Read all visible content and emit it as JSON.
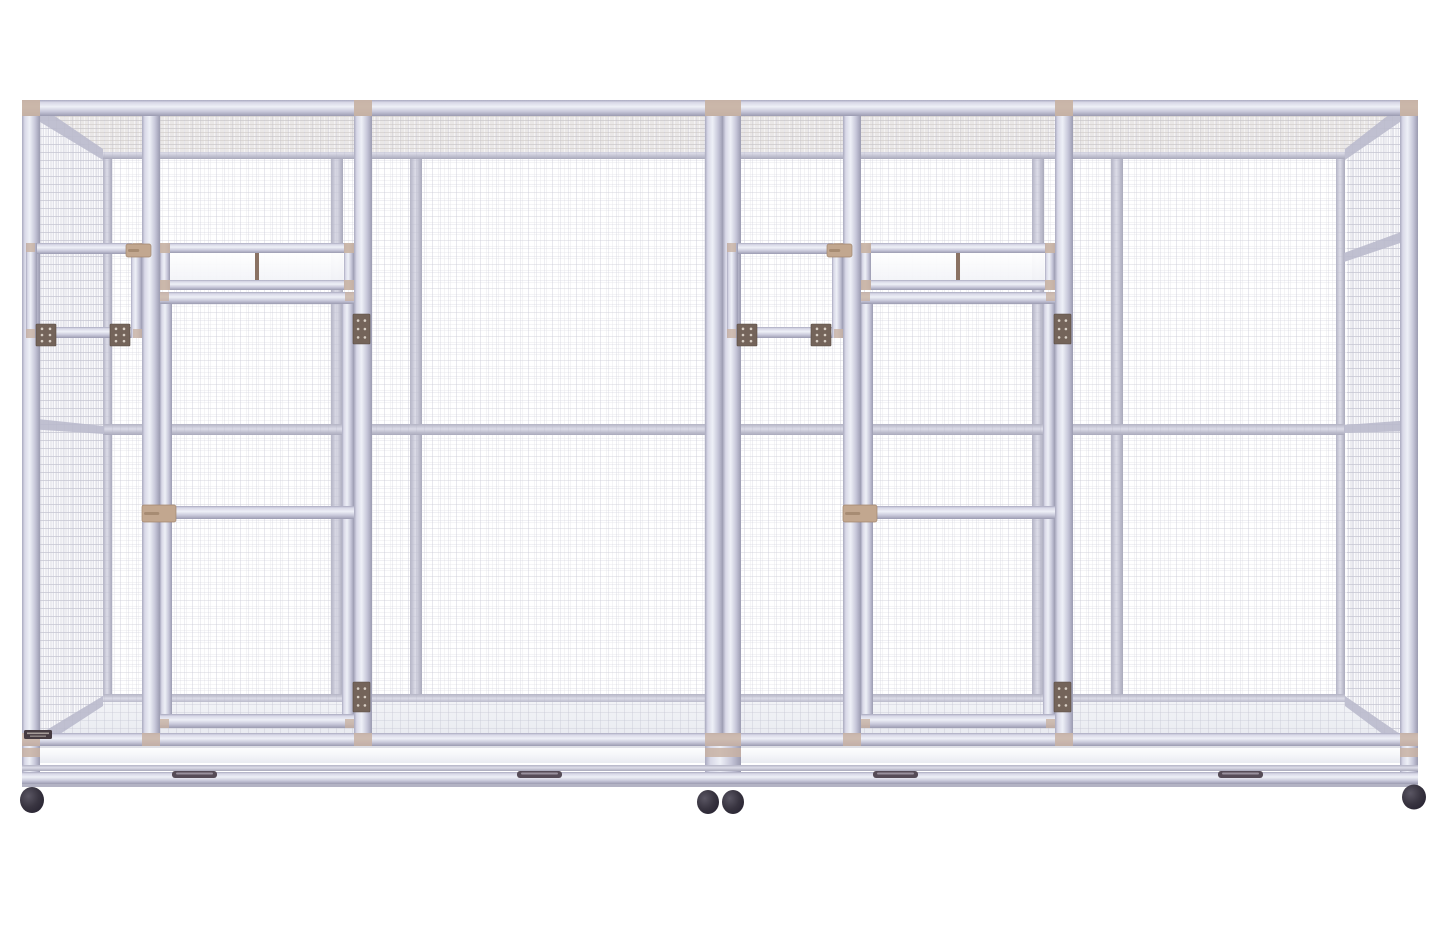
{
  "scene": {
    "width": 1445,
    "height": 927,
    "background": "#ffffff",
    "alt": "White aluminium double flight bird aviary cage with wire mesh panels, two hinged doors with transom windows, two small feeder hatches, pull-out base trays and black caster wheels"
  },
  "colors": {
    "frameMid": "#c9c9da",
    "frameLight": "#eef0f7",
    "frameShadow": "#9b9bb1",
    "meshFront": "#b4b4c6",
    "meshBack": "#c3c3d0",
    "meshSide": "#b0b0c2",
    "meshRoof": "#c2bab3",
    "meshFloor": "#d2d5de",
    "cap": "#c8b2a3",
    "hinge": "#74645a",
    "hingeEdge": "#584b42",
    "screw": "#d9d0c6",
    "latch": "#c2a78f",
    "latchEdge": "#a2876f",
    "mullion": "#8a7263",
    "panel": "#fcfcfe",
    "tray": "#f8f9fb",
    "handle": "#564c57",
    "wheel": "#322e38",
    "label": "#463b41",
    "sideRail": "#bdbdcf"
  },
  "front": {
    "left": 22,
    "right": 1418,
    "top": 100,
    "topRailH": 16,
    "bottomY": 733,
    "bottomRailH": 13,
    "meshTop": 108,
    "meshBottom": 746,
    "postW": 18,
    "posts": [
      22,
      142,
      354,
      705,
      723,
      843,
      1055,
      1400
    ],
    "topCaps": [
      [
        22,
        18
      ],
      [
        354,
        18
      ],
      [
        705,
        36
      ],
      [
        1055,
        18
      ],
      [
        1400,
        18
      ]
    ],
    "bottomCaps": [
      [
        22,
        18
      ],
      [
        142,
        18
      ],
      [
        354,
        18
      ],
      [
        705,
        36
      ],
      [
        843,
        18
      ],
      [
        1055,
        18
      ],
      [
        1400,
        18
      ]
    ]
  },
  "back": {
    "left": 103,
    "right": 1345,
    "top": 149,
    "railH": 11,
    "midY": 424,
    "bottomY": 694,
    "bottomRailH": 10,
    "cornerPostW": 9,
    "innerPosts": [
      331,
      410,
      1032,
      1111
    ],
    "innerPostW": 12
  },
  "roof": {
    "poly": [
      [
        40,
        110
      ],
      [
        1400,
        110
      ],
      [
        1345,
        152
      ],
      [
        103,
        152
      ]
    ],
    "fill": "#f4f3f5"
  },
  "floor": {
    "poly": [
      [
        40,
        744
      ],
      [
        103,
        702
      ],
      [
        1345,
        702
      ],
      [
        1402,
        744
      ]
    ]
  },
  "sides": {
    "left": {
      "mesh": [
        [
          27,
          112
        ],
        [
          103,
          155
        ],
        [
          103,
          700
        ],
        [
          27,
          744
        ]
      ],
      "rails": [
        [
          [
            40,
            106
          ],
          [
            103,
            149
          ],
          [
            103,
            160
          ],
          [
            40,
            122
          ]
        ],
        [
          [
            28,
            418
          ],
          [
            104,
            426
          ],
          [
            104,
            434
          ],
          [
            28,
            429
          ]
        ],
        [
          [
            40,
            734
          ],
          [
            103,
            696
          ],
          [
            103,
            706
          ],
          [
            40,
            747
          ]
        ]
      ]
    },
    "right": {
      "mesh": [
        [
          1413,
          112
        ],
        [
          1347,
          155
        ],
        [
          1347,
          700
        ],
        [
          1413,
          744
        ]
      ],
      "rails": [
        [
          [
            1400,
            106
          ],
          [
            1345,
            149
          ],
          [
            1345,
            160
          ],
          [
            1400,
            122
          ]
        ],
        [
          [
            1412,
            228
          ],
          [
            1344,
            253
          ],
          [
            1344,
            262
          ],
          [
            1412,
            239
          ]
        ],
        [
          [
            1412,
            420
          ],
          [
            1344,
            425
          ],
          [
            1344,
            433
          ],
          [
            1412,
            431
          ]
        ],
        [
          [
            1400,
            734
          ],
          [
            1345,
            696
          ],
          [
            1345,
            706
          ],
          [
            1400,
            747
          ]
        ]
      ]
    }
  },
  "units": [
    {
      "origin": 22,
      "name": "left"
    },
    {
      "origin": 723,
      "name": "right"
    }
  ],
  "unitParts": {
    "hatch": {
      "x": 4,
      "y": 243,
      "w": 116,
      "h": 95,
      "bar": 11,
      "hingeXs": [
        14,
        88
      ],
      "hingeY": 324,
      "hingeW": 20,
      "hingeH": 22,
      "latch": {
        "x": 104,
        "y": 244,
        "w": 25,
        "h": 13
      }
    },
    "transom": {
      "x": 138,
      "y": 243,
      "w": 194,
      "h": 47,
      "bar": 10,
      "mullionX": 233,
      "mullionW": 4,
      "capSize": 10
    },
    "door": {
      "x": 138,
      "w": 194,
      "top": 292,
      "bottom": 728,
      "stile": 12,
      "railH": 13,
      "midY": 506,
      "latch": {
        "x": 120,
        "y": 505,
        "w": 34,
        "h": 17
      },
      "hingeX": 331,
      "hingeYs": [
        314,
        682
      ],
      "hingeW": 17,
      "hingeH": 30,
      "capSize": 9
    }
  },
  "base": {
    "trayY": 746,
    "trayH": 17,
    "rail1Y": 765,
    "rail1H": 6,
    "rail2Y": 772,
    "rail2H": 12,
    "edgeY": 784,
    "edgeH": 3,
    "legs": [
      [
        22,
        18
      ],
      [
        705,
        36
      ],
      [
        1400,
        18
      ]
    ],
    "legBottom": 785,
    "handles": {
      "xs": [
        172,
        517,
        873,
        1218
      ],
      "y": 771,
      "w": 45,
      "h": 7
    },
    "label": {
      "x": 24,
      "y": 730,
      "w": 28,
      "h": 9
    },
    "wheels": [
      [
        32,
        800,
        12,
        13
      ],
      [
        708,
        802,
        11,
        12
      ],
      [
        733,
        802,
        11,
        12
      ],
      [
        1414,
        797,
        12,
        12.5
      ]
    ]
  }
}
